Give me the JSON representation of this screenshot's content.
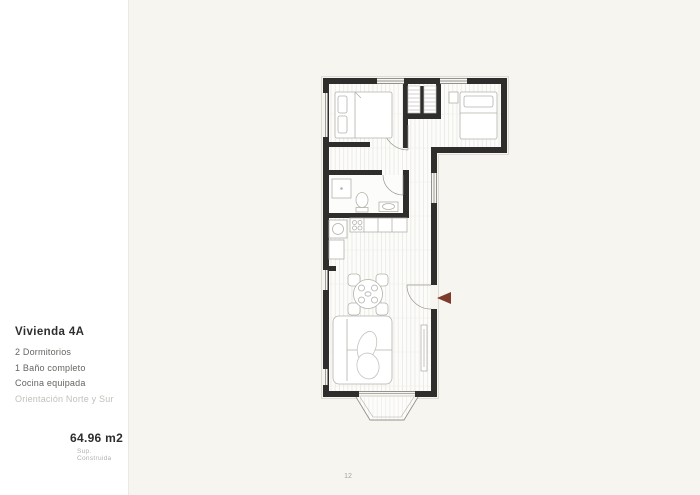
{
  "sidebar": {
    "title": "Vivienda 4A",
    "features": [
      "2 Dormitorios",
      "1 Baño completo",
      "Cocina equipada"
    ],
    "orientation": "Orientación Norte y Sur",
    "area_value": "64.96 m2",
    "area_label": "Sup. Construida"
  },
  "floorplan": {
    "description": "floor-plan-vivienda-4a",
    "colors": {
      "wall": "#2f2e2c",
      "floor": "#fcfcfa",
      "plank_line": "#e8e5df",
      "furniture_stroke": "#b4b1aa",
      "window_line": "#96938e",
      "entrance_arrow": "#7c3b2b",
      "canvas_background": "#f7f5f0",
      "panel_background": "#ffffff"
    }
  },
  "footer": {
    "page_number": "12"
  }
}
